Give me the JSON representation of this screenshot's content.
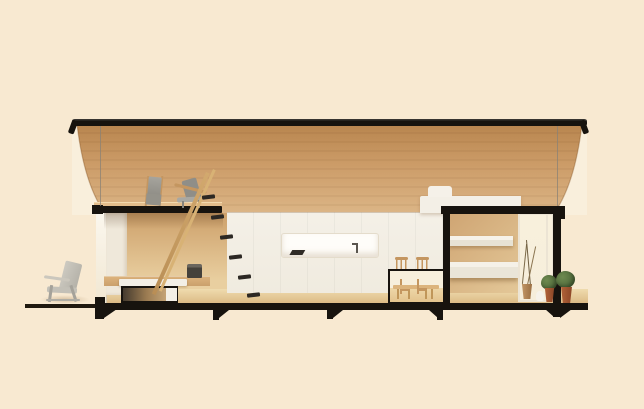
{
  "colors": {
    "bg": "#f8e9d1",
    "black-structure": "#17130e",
    "roof-highlight": "#4a433a",
    "vault-skin": "#f9efdc",
    "wood-ceiling-top": "#b8854e",
    "wood-ceiling-mid": "#cc9c68",
    "wood-ceiling-bottom": "#dcb687",
    "wood-wall": "#cda06a",
    "wood-wall-light": "#e9cfa0",
    "wood-floor-light": "#efdbae",
    "wood-floor-dark": "#dcbb86",
    "white-wall": "#f2eee4",
    "white-bright": "#fefdf9",
    "white-furniture": "#f3efe6",
    "window-frame": "#ece4d4",
    "glass": "#f6eedb",
    "cable": "#8a8175",
    "gray-chair": "#a9a8a2",
    "gray-chair-dark": "#8f8e88",
    "wood-frame": "#c49660",
    "dark-object": "#4b4742",
    "plant-green": "#6e8a50",
    "plant-green-dark": "#4c6638",
    "pot-terracotta": "#b5653a",
    "pot-terracotta-dark": "#8a4526",
    "deck-shadow": "rgba(140,100,50,0.30)"
  }
}
